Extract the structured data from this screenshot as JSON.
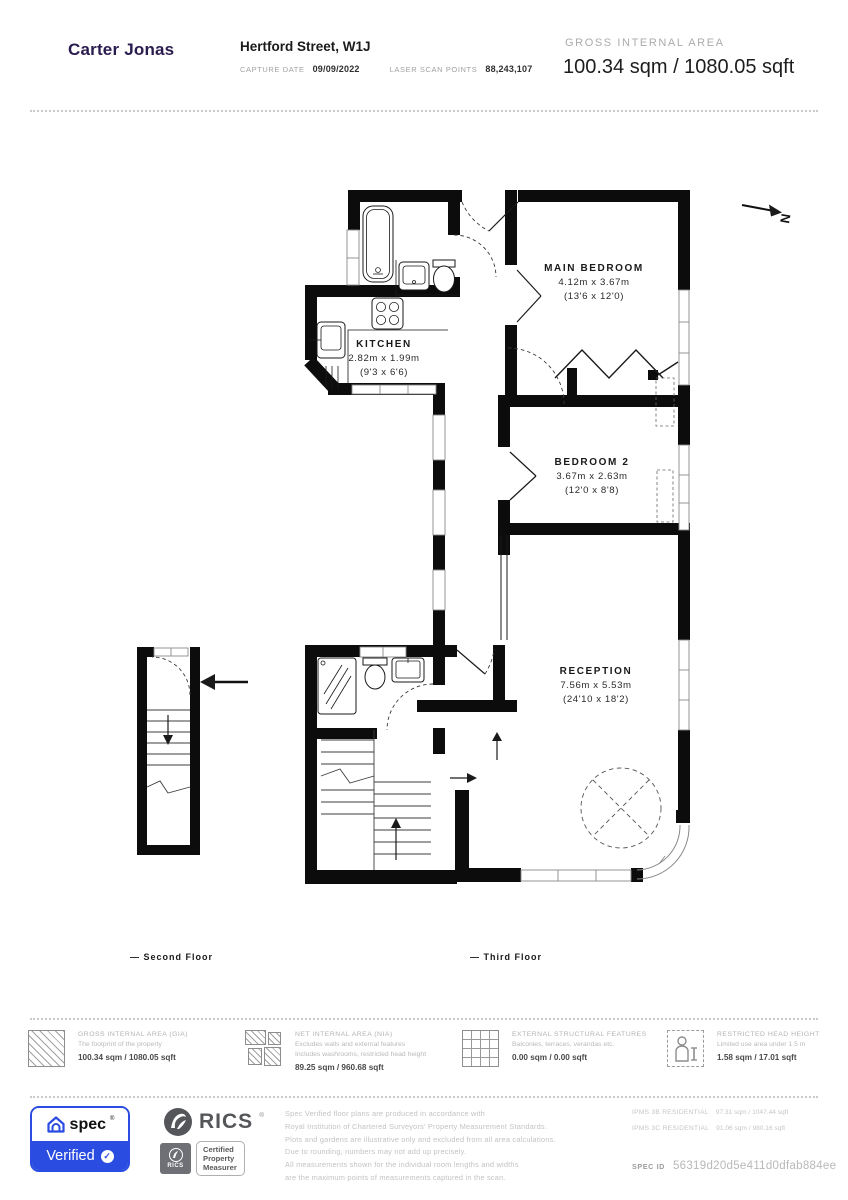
{
  "header": {
    "logo": "Carter Jonas",
    "address": "Hertford Street, W1J",
    "capture_date_label": "CAPTURE DATE",
    "capture_date": "09/09/2022",
    "laser_scan_label": "LASER SCAN POINTS",
    "laser_scan_points": "88,243,107",
    "gia_label": "GROSS INTERNAL AREA",
    "gia_value": "100.34 sqm / 1080.05 sqft"
  },
  "plan": {
    "north_label": "N",
    "rooms": [
      {
        "name": "MAIN BEDROOM",
        "metric": "4.12m x 3.67m",
        "imperial": "(13'6 x 12'0)"
      },
      {
        "name": "KITCHEN",
        "metric": "2.82m x 1.99m",
        "imperial": "(9'3 x 6'6)"
      },
      {
        "name": "BEDROOM 2",
        "metric": "3.67m x 2.63m",
        "imperial": "(12'0 x 8'8)"
      },
      {
        "name": "RECEPTION",
        "metric": "7.56m x 5.53m",
        "imperial": "(24'10 x 18'2)"
      }
    ],
    "floor_labels": [
      {
        "label": "— Second Floor"
      },
      {
        "label": "— Third Floor"
      }
    ]
  },
  "legend": {
    "items": [
      {
        "icon": "gia-hatched-square",
        "title": "GROSS INTERNAL AREA (GIA)",
        "lines": [
          "The footprint of the property"
        ],
        "value": "100.34 sqm / 1080.05 sqft"
      },
      {
        "icon": "nia-hatched-puzzle",
        "title": "NET INTERNAL AREA (NIA)",
        "lines": [
          "Excludes walls and external features",
          "Includes washrooms, restricted head height"
        ],
        "value": "89.25 sqm / 960.68 sqft"
      },
      {
        "icon": "external-grid",
        "title": "EXTERNAL STRUCTURAL FEATURES",
        "lines": [
          "Balconies, terraces, verandas etc."
        ],
        "value": "0.00 sqm / 0.00 sqft"
      },
      {
        "icon": "restricted-head-height-person",
        "title": "RESTRICTED HEAD HEIGHT",
        "lines": [
          "Limited use area under 1.5 m"
        ],
        "value": "1.58 sqm / 17.01 sqft"
      }
    ]
  },
  "footer": {
    "spec": {
      "brand": "spec",
      "reg": "®",
      "verified": "Verified",
      "check_icon": "✓"
    },
    "rics": {
      "name": "RICS",
      "reg": "®",
      "badge_name": "RICS",
      "certified_lines": [
        "Certified",
        "Property",
        "Measurer"
      ]
    },
    "disclaimer": [
      "Spec Verified floor plans are produced in accordance with",
      "Royal Institution of Chartered Surveyors' Property Measurement Standards.",
      "Plots and gardens are illustrative only and excluded from all area calculations.",
      "Due to rounding, numbers may not add up precisely.",
      "All measurements shown for the individual room lengths and widths",
      "are the maximum points of measurements captured in the scan."
    ],
    "ipms": [
      {
        "label": "IPMS 3B RESIDENTIAL",
        "value": "97.31 sqm / 1047.44 sqft"
      },
      {
        "label": "IPMS 3C RESIDENTIAL",
        "value": "91.06 sqm / 980.16 sqft"
      }
    ],
    "spec_id_label": "SPEC ID",
    "spec_id": "56319d20d5e411d0dfab884ee"
  },
  "colors": {
    "spec_blue": "#2b4ce0",
    "carter_purple": "#2b1c4f",
    "rics_gray": "#54565a"
  }
}
